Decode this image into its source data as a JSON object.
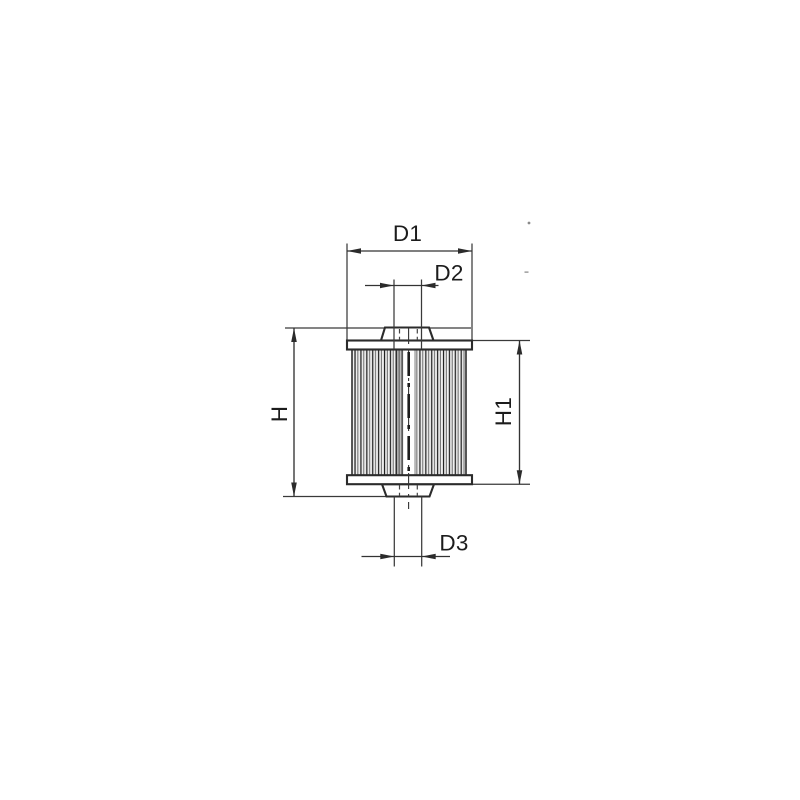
{
  "diagram": {
    "type": "technical-drawing",
    "subject": "filter-element-cross-section",
    "labels": {
      "d1": "D1",
      "d2": "D2",
      "d3": "D3",
      "h": "H",
      "h1": "H1"
    },
    "colors": {
      "line": "#2b2b2b",
      "text": "#1c1c1c",
      "background": "#ffffff"
    }
  }
}
